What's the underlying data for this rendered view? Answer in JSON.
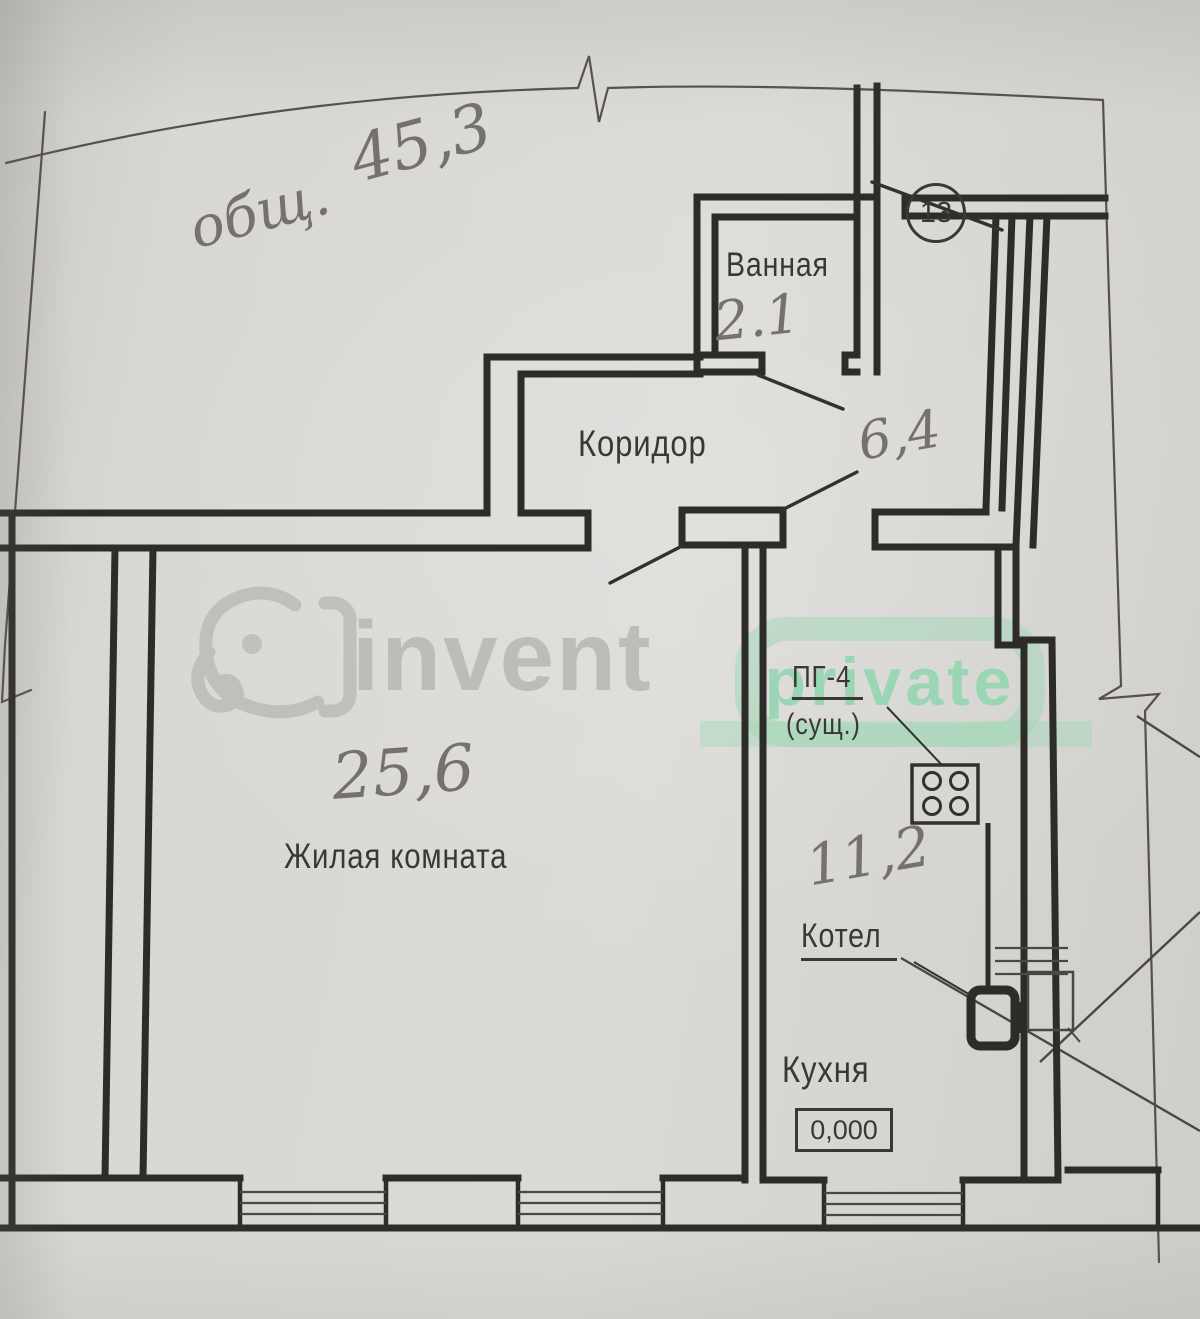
{
  "plan": {
    "handwritten_total_prefix": "общ.",
    "handwritten_total_value": "45,3",
    "door_badge_number": "13",
    "rooms": [
      {
        "name": "Ванная",
        "area": "2.1"
      },
      {
        "name": "Коридор",
        "area": "6,4"
      },
      {
        "name": "Жилая комната",
        "area": "25,6"
      },
      {
        "name": "Кухня",
        "area": "11,2"
      }
    ],
    "equipment": {
      "stove_label": "ПГ-4",
      "stove_note": "(сущ.)",
      "boiler_label": "Котел",
      "elevation_mark": "0,000"
    }
  },
  "watermark": {
    "brand": "invent",
    "badge": "private"
  },
  "colors": {
    "paper": "#d7d6d2",
    "ink": "#2e2c29",
    "pencil": "#75726c",
    "thin_line": "#55524d",
    "watermark_gray": "#b1b0ac",
    "watermark_green": "#9ed8b6"
  }
}
